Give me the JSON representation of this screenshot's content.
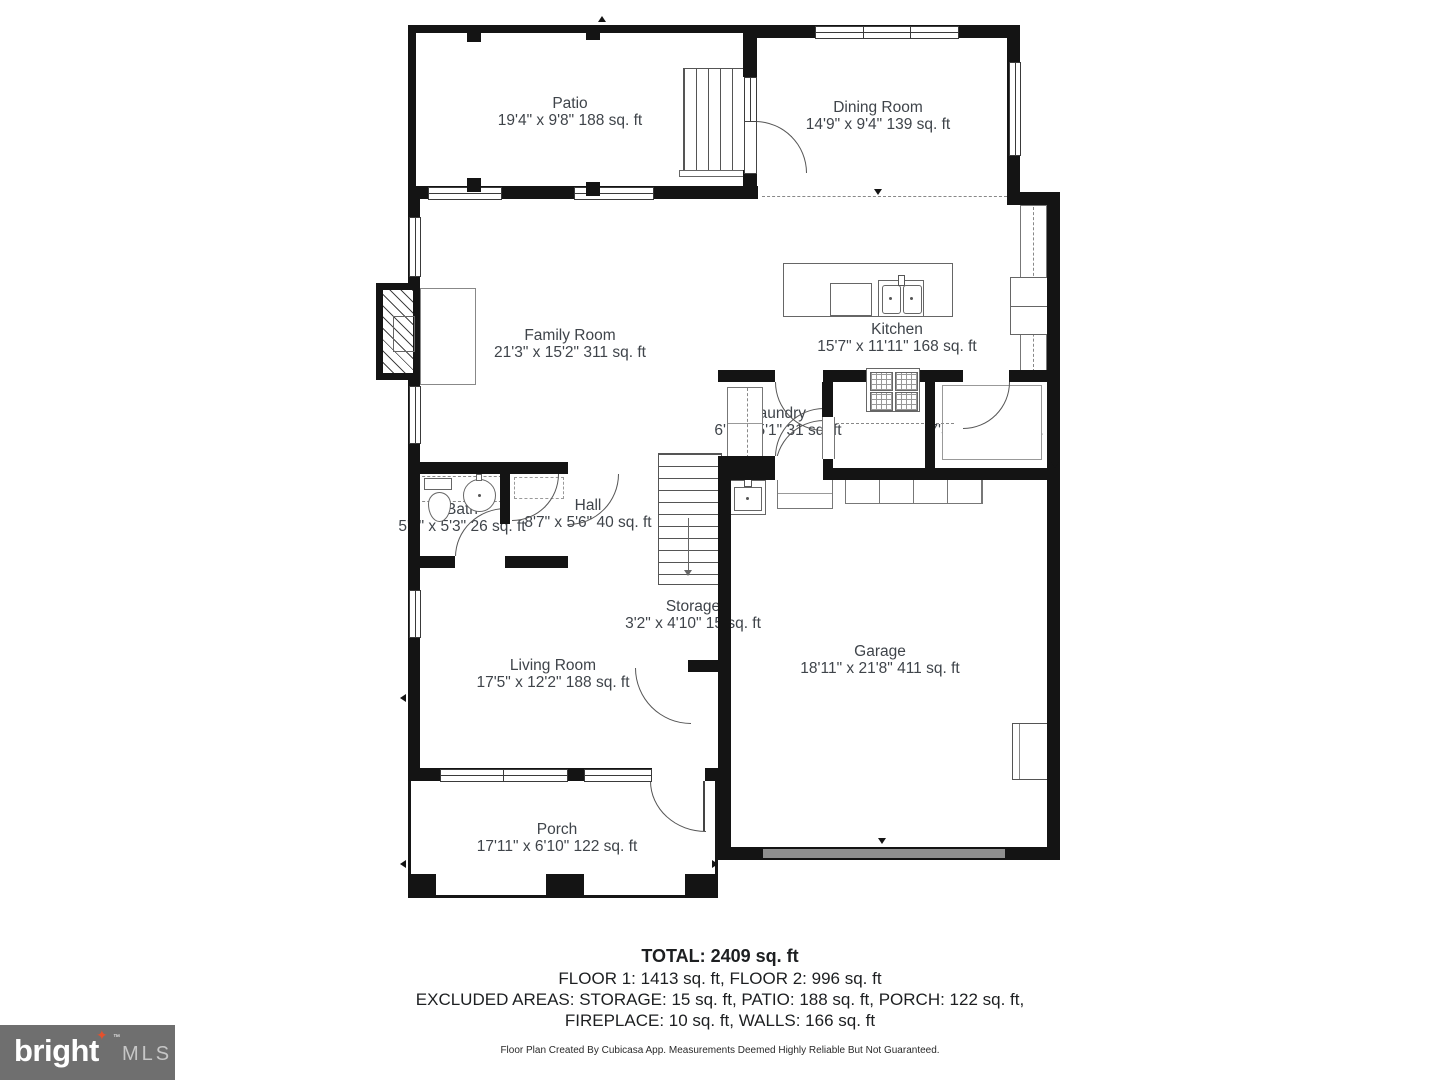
{
  "rooms": {
    "patio": {
      "name": "Patio",
      "dims": "19'4\" x 9'8\" 188 sq. ft"
    },
    "dining": {
      "name": "Dining Room",
      "dims": "14'9\" x 9'4\" 139 sq. ft"
    },
    "family": {
      "name": "Family Room",
      "dims": "21'3\" x 15'2\" 311 sq. ft"
    },
    "kitchen": {
      "name": "Kitchen",
      "dims": "15'7\" x 11'11\" 168 sq. ft"
    },
    "laundry": {
      "name": "Laundry",
      "dims": "6'1\" x 5'1\" 31 sq. ft"
    },
    "pantry": {
      "name": "Pantry",
      "dims": "7'5\" x 5'1\" 34 sq. ft"
    },
    "bath": {
      "name": "Bath",
      "dims": "5'0\" x 5'3\" 26 sq. ft"
    },
    "hall": {
      "name": "Hall",
      "dims": "8'7\" x 5'6\" 40 sq. ft"
    },
    "storage": {
      "name": "Storage",
      "dims": "3'2\" x 4'10\" 15 sq. ft"
    },
    "living": {
      "name": "Living Room",
      "dims": "17'5\" x 12'2\" 188 sq. ft"
    },
    "garage": {
      "name": "Garage",
      "dims": "18'11\" x 21'8\" 411 sq. ft"
    },
    "porch": {
      "name": "Porch",
      "dims": "17'11\" x 6'10\" 122 sq. ft"
    }
  },
  "summary": {
    "total": "TOTAL: 2409 sq. ft",
    "floors": "FLOOR 1: 1413 sq. ft, FLOOR 2: 996 sq. ft",
    "excluded1": "EXCLUDED AREAS: STORAGE: 15 sq. ft, PATIO: 188 sq. ft, PORCH: 122 sq. ft,",
    "excluded2": "FIREPLACE: 10 sq. ft, WALLS: 166 sq. ft",
    "disclaimer": "Floor Plan Created By Cubicasa App. Measurements Deemed Highly Reliable But Not Guaranteed."
  },
  "branding": {
    "logo_text": "bright",
    "logo_star": "✦",
    "logo_tm": "™",
    "logo_suffix": "MLS"
  },
  "colors": {
    "wall": "#141414",
    "label_text": "#3f444a",
    "garage_door": "#8f8f8f",
    "logo_bg": "#6f6f6f",
    "logo_accent": "#e4512d"
  }
}
